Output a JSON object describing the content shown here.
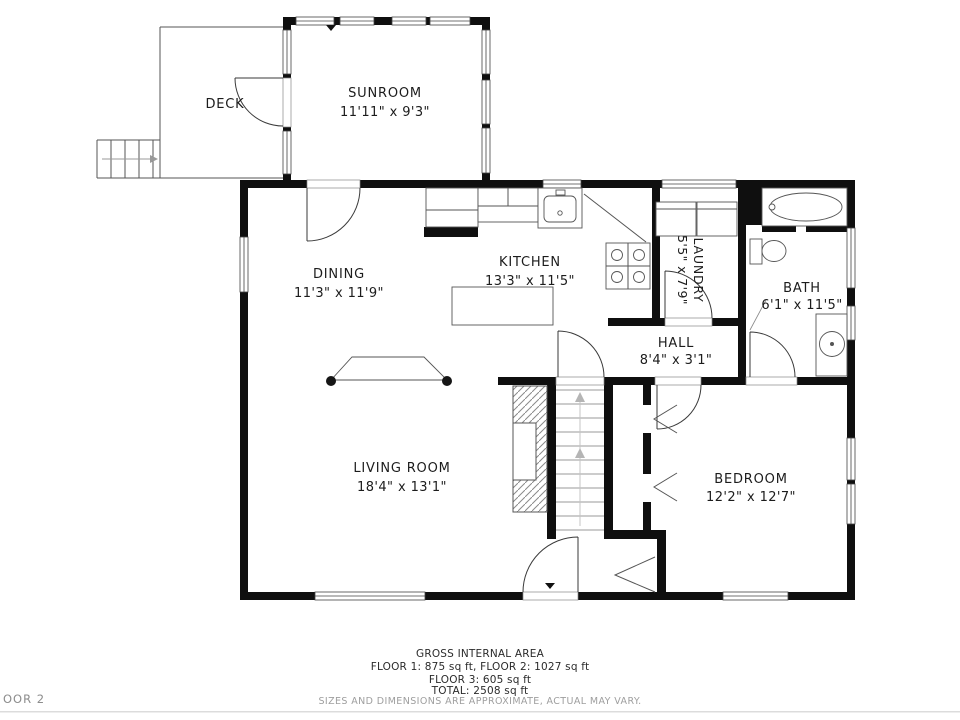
{
  "floor_tag": "OOR 2",
  "rooms": {
    "deck": {
      "name": "DECK"
    },
    "sunroom": {
      "name": "SUNROOM",
      "dims": "11'11\" x 9'3\""
    },
    "dining": {
      "name": "DINING",
      "dims": "11'3\" x 11'9\""
    },
    "kitchen": {
      "name": "KITCHEN",
      "dims": "13'3\" x 11'5\""
    },
    "laundry": {
      "name": "LAUNDRY",
      "dims": "5'5\" x 7'9\""
    },
    "hall": {
      "name": "HALL",
      "dims": "8'4\" x 3'1\""
    },
    "bath": {
      "name": "BATH",
      "dims": "6'1\" x 11'5\""
    },
    "living": {
      "name": "LIVING ROOM",
      "dims": "18'4\" x 13'1\""
    },
    "bedroom": {
      "name": "BEDROOM",
      "dims": "12'2\" x 12'7\""
    }
  },
  "footer": {
    "title": "GROSS INTERNAL AREA",
    "line1": "FLOOR 1: 875 sq ft, FLOOR 2: 1027 sq ft",
    "line2": "FLOOR 3: 605 sq ft",
    "line3": "TOTAL: 2508 sq ft",
    "disclaimer": "SIZES AND DIMENSIONS ARE APPROXIMATE, ACTUAL MAY VARY."
  },
  "colors": {
    "wall": "#0f0f0f",
    "fixture_line": "#555555",
    "muted_text": "#9e9e9e"
  }
}
